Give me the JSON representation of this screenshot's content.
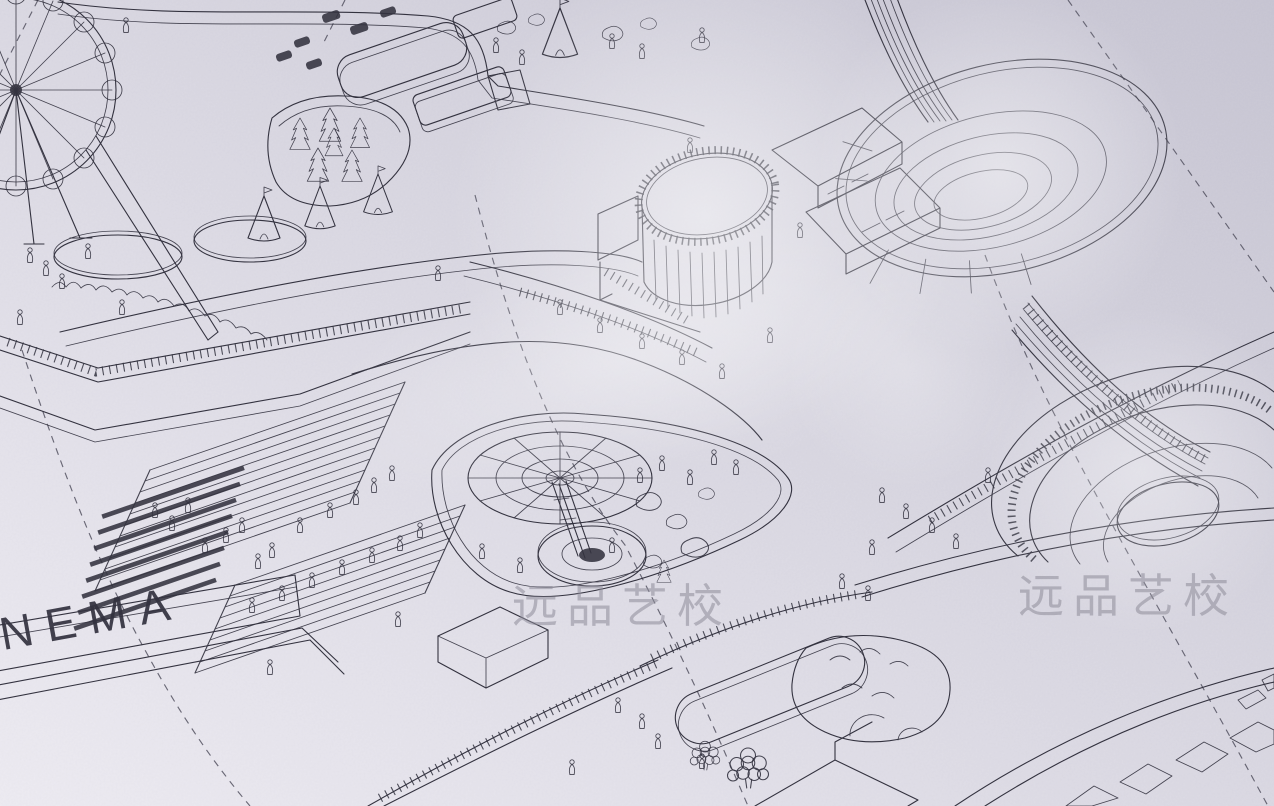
{
  "meta": {
    "description": "Photograph, taken at an angle, of a hand-drawn isometric architectural master-plan illustration of an amusement / leisure park printed on lavender-grey paper with glossy glare patches",
    "drawing_style": "thin black ink line art, isometric, with dashed survey lines and tiny pedestrian figures"
  },
  "labels": {
    "cinema_sign": "CINEMA"
  },
  "watermark": {
    "text": "远品艺校",
    "instances": 2
  },
  "colors": {
    "paper-light": "#edebf2",
    "paper-mid": "#dcdae4",
    "paper-dark": "#c6c4d2",
    "line": "#33323f",
    "line-faint": "#55546a",
    "dash": "#4a4958",
    "watermark": "#8e8c99",
    "glare": "#ffffff"
  },
  "elements": [
    "ferris-wheel",
    "oval-ponds",
    "cone-tents",
    "garden-grid-slabs",
    "greenhouse-with-pines",
    "drum-tower",
    "angular-buildings",
    "oval-stadium",
    "striped-bridge",
    "spiral-ramp",
    "amphitheater-stairs",
    "audience-figures",
    "cinema-wall",
    "carousel-plaza",
    "fountain-canopy",
    "rock-garden",
    "oval-pond",
    "balloon-tree",
    "promenades",
    "railings",
    "dashed-survey-lines",
    "pedestrian-figures",
    "paper-glare",
    "watermark-text"
  ]
}
